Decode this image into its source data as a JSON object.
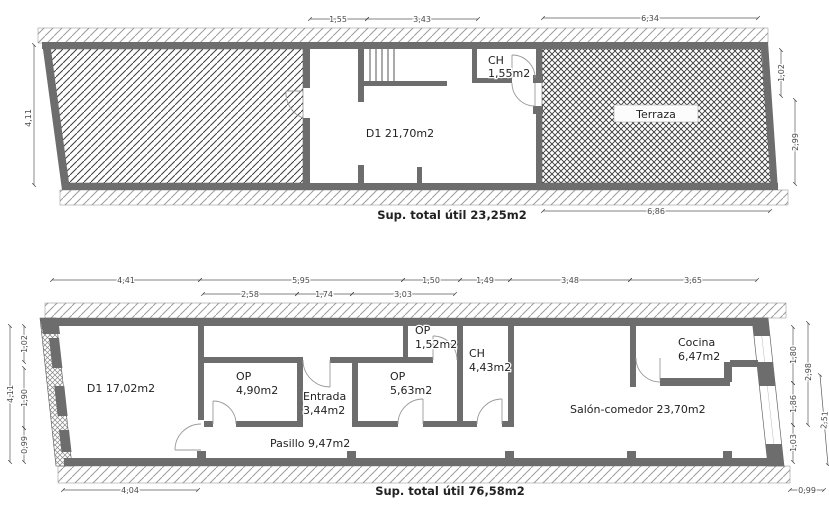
{
  "upper_plan": {
    "rooms": {
      "d1": "D1 21,70m2",
      "ch_line1": "CH",
      "ch_line2": "1,55m2",
      "terraza": "Terraza"
    },
    "total": "Sup. total útil 23,25m2",
    "dims": {
      "top_1": "1,55",
      "top_2": "3,43",
      "top_3": "6,34",
      "left": "4,11",
      "right_1": "1,02",
      "right_2": "2,99",
      "bottom": "6,86"
    }
  },
  "lower_plan": {
    "rooms": {
      "d1": "D1 17,02m2",
      "op1_line1": "OP",
      "op1_line2": "4,90m2",
      "entrada_line1": "Entrada",
      "entrada_line2": "3,44m2",
      "op2_line1": "OP",
      "op2_line2": "5,63m2",
      "op3_line1": "OP",
      "op3_line2": "1,52m2",
      "ch_line1": "CH",
      "ch_line2": "4,43m2",
      "cocina_line1": "Cocina",
      "cocina_line2": "6,47m2",
      "salon": "Salón-comedor 23,70m2",
      "pasillo": "Pasillo 9,47m2"
    },
    "total": "Sup. total útil 76,58m2",
    "dims": {
      "top_row1": [
        "4,41",
        "5,95",
        "1,50",
        "1,49",
        "3,48",
        "3,65"
      ],
      "top_row2": [
        "2,58",
        "1,74",
        "3,03"
      ],
      "left_total": "4,11",
      "left_segs": [
        "1,02",
        "1,90",
        "0,99"
      ],
      "right_segs": [
        "1,80",
        "1,86",
        "1,03"
      ],
      "right_total": "2,98",
      "right_outer": "2,51",
      "bottom_left": "4,04",
      "bottom_right": "0,99"
    }
  },
  "colors": {
    "wall": "#6d6d6d",
    "dim_text": "#4a4a4a",
    "label_text": "#222222"
  }
}
